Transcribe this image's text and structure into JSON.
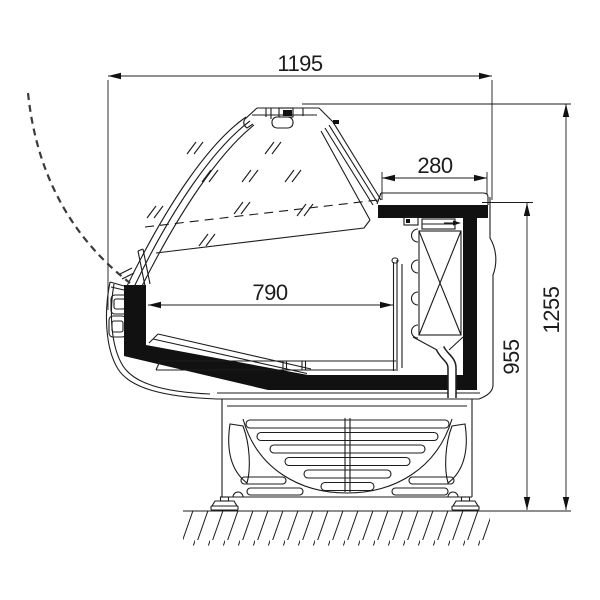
{
  "dimensions": {
    "overall_width": {
      "label": "1195"
    },
    "worktop_depth": {
      "label": "280"
    },
    "display_depth": {
      "label": "790"
    },
    "worktop_height": {
      "label": "955"
    },
    "overall_height": {
      "label": "1255"
    }
  },
  "style": {
    "line_color": "#1c1c1c",
    "black_fill": "#111111",
    "background": "#ffffff"
  }
}
